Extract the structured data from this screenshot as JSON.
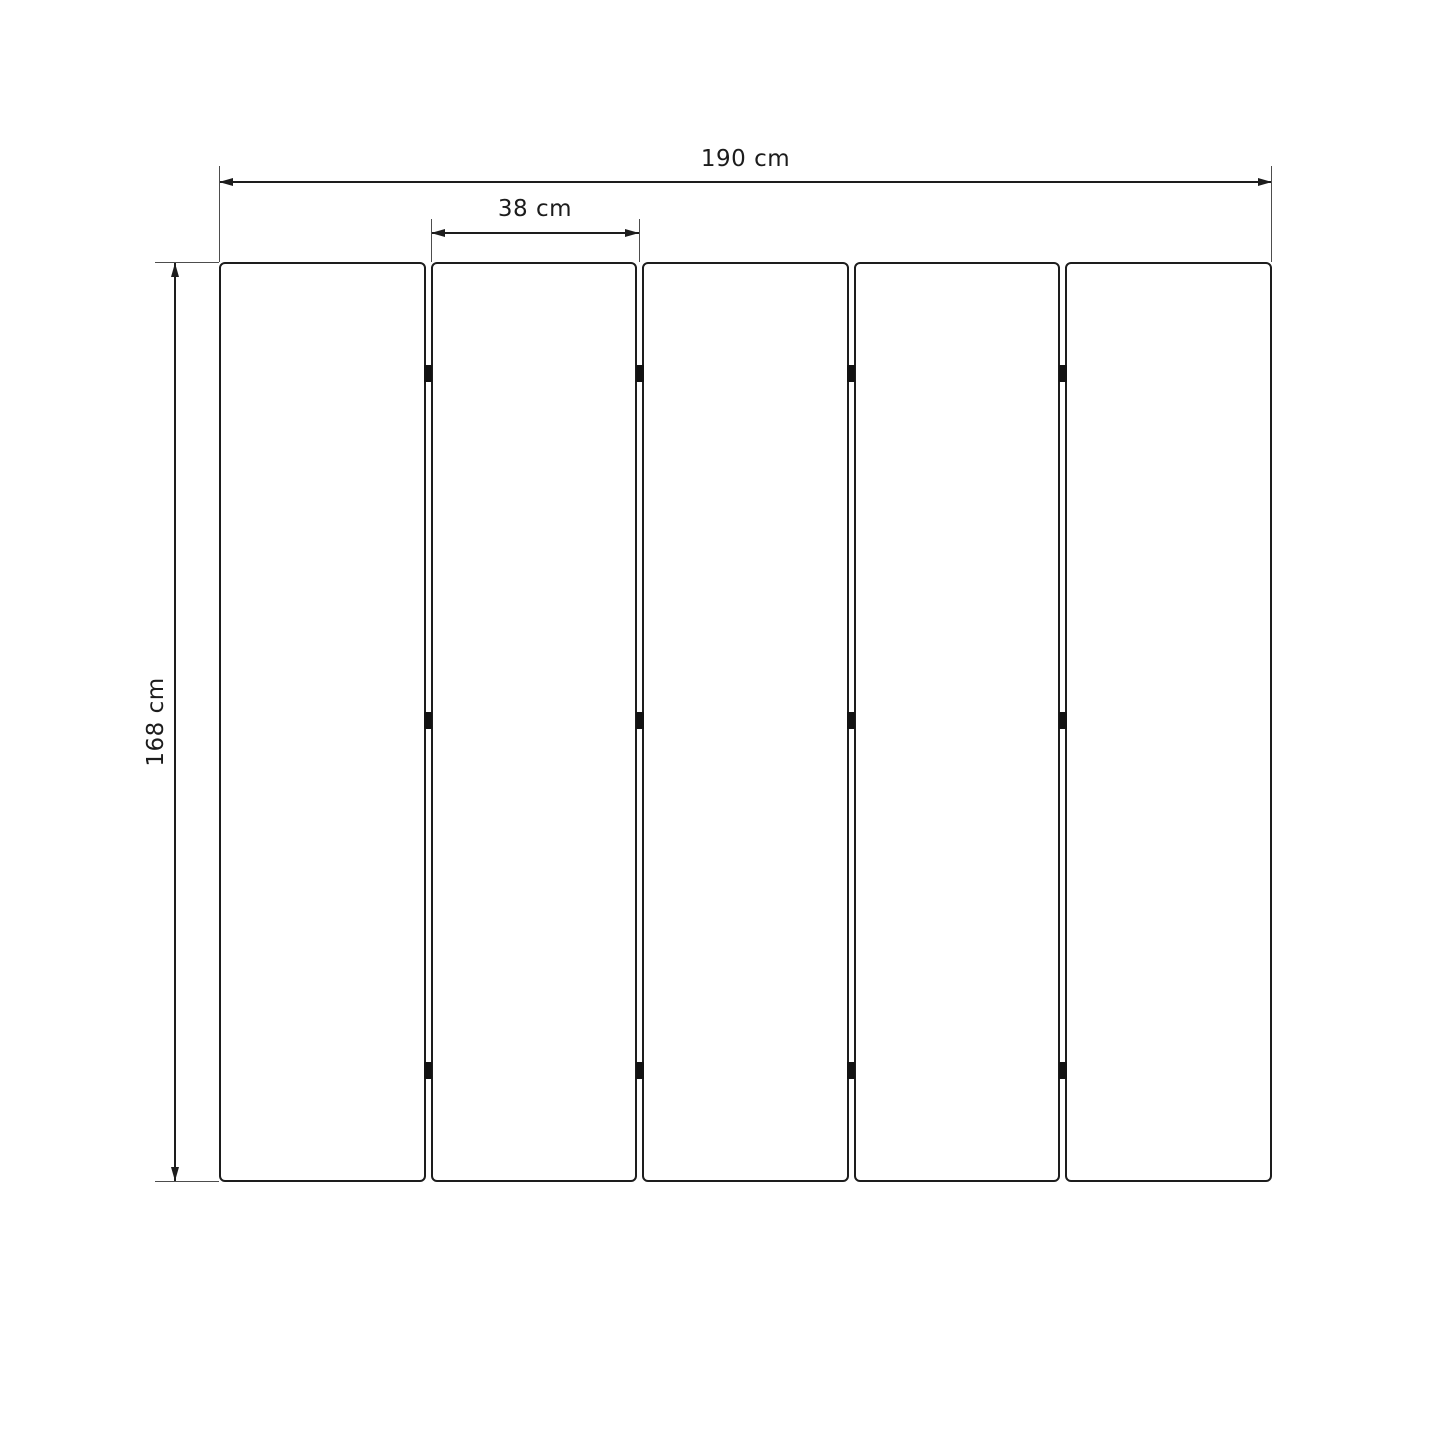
{
  "diagram": {
    "type": "dimension-drawing",
    "dimensions": {
      "total_width": {
        "label": "190 cm"
      },
      "single_panel_width": {
        "label": "38 cm"
      },
      "height": {
        "label": "168 cm"
      }
    },
    "panels": {
      "count": 5,
      "junctions": 4,
      "hinge_rows_per_junction": 3,
      "hinge_row_fractions": [
        0.1217,
        0.4989,
        0.8783
      ]
    },
    "colors": {
      "line": "#1d1d1d",
      "extension_line": "#4d4d4d",
      "hinge": "#121212",
      "text": "#1c1c1c",
      "background": "#ffffff"
    }
  }
}
